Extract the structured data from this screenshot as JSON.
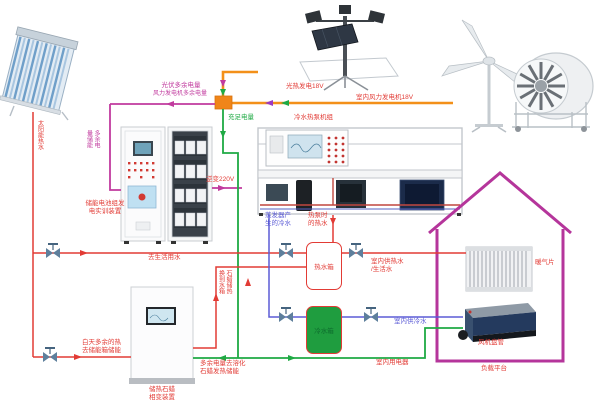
{
  "colors": {
    "generation_orange": "#f39019",
    "surplus_magenta": "#c13a9e",
    "power_green": "#1faa44",
    "hot_water_red": "#e23b35",
    "cold_water_blue": "#5b5bd6",
    "house_outline": "#b5359b",
    "cold_tank_fill": "#1f9d3f"
  },
  "labels": {
    "pv_surplus": "光伏多余电量",
    "wind_surplus": "风力发电机多余电量",
    "sufficient_power": "充足电量",
    "solar_thermal_gen": "光热发电18V",
    "indoor_wind_gen": "室内风力发电机18V",
    "heat_pump_unit": "冷水热泵机组",
    "surplus_storage": "多余电\n量储能",
    "battery_cabinet": "储能电池组发\n电实训装置",
    "inverter": "逆变220V",
    "solar_hot_water": "太阳能热水",
    "to_domestic_water": "去生活用水",
    "day_surplus_heat": "白天多余的热\n去储能箱储能",
    "paraffin_device": "储热石蜡\n相变装置",
    "paraffin_to_tank": "石蜡储热\n换到水箱",
    "evaporator_cold": "蒸发器产\n生的冷水",
    "heat_pump_hot": "热泵时\n的热水",
    "hot_tank": "热水箱",
    "cold_tank": "冷水箱",
    "indoor_hot_water": "室内供热水\n/生活水",
    "indoor_cold_water": "室内供冷水",
    "indoor_appliance": "室内用电器",
    "melt_paraffin": "多余电量去溶化\n石蜡发热储能",
    "radiator": "暖气片",
    "fan_coil": "风机盘管",
    "load_platform": "负载平台"
  }
}
